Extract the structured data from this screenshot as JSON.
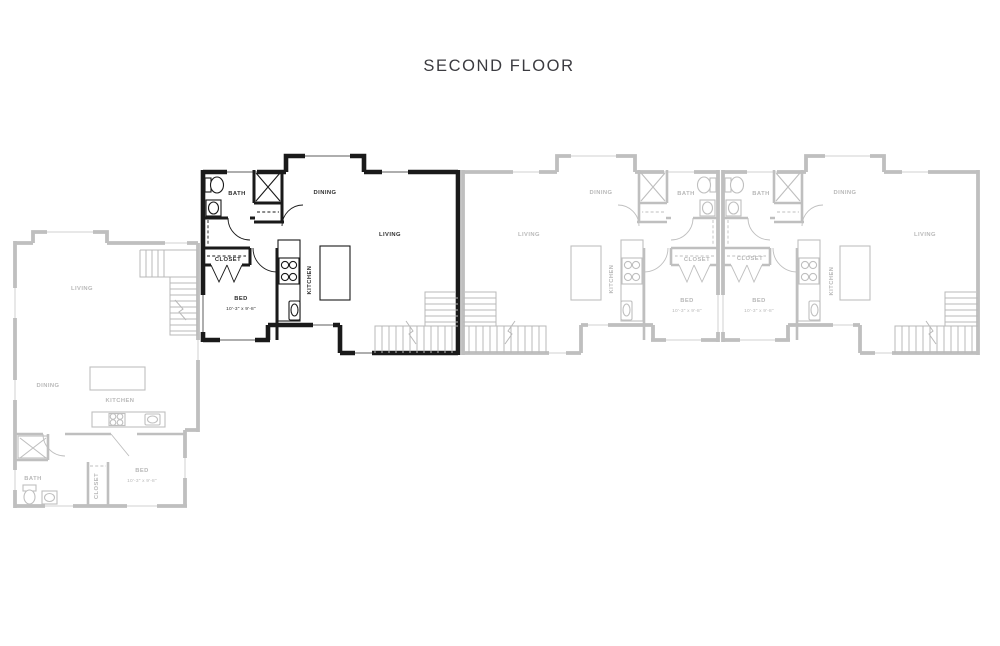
{
  "title": "SECOND FLOOR",
  "colors": {
    "background": "#ffffff",
    "highlight": "#1a1a1a",
    "faded": "#bfbfbf",
    "stairs": "#b8b8b8",
    "title_text": "#3b3b40",
    "label_text_highlight": "#2e2e2e",
    "label_text_faded": "#b8b8b8"
  },
  "units": [
    {
      "id": "unit-1",
      "state": "faded",
      "labels": {
        "living": "LIVING",
        "dining": "DINING",
        "kitchen": "KITCHEN",
        "bath": "BATH",
        "closet": "CLOSET",
        "bed": "BED",
        "bed_dimensions": "10'-3\" x 9'-8\""
      }
    },
    {
      "id": "unit-2",
      "state": "highlighted",
      "labels": {
        "living": "LIVING",
        "dining": "DINING",
        "kitchen": "KITCHEN",
        "bath": "BATH",
        "closet": "CLOSET",
        "bed": "BED",
        "bed_dimensions": "10'-3\" x 9'-8\""
      }
    },
    {
      "id": "unit-3",
      "state": "faded",
      "labels": {
        "living": "LIVING",
        "dining": "DINING",
        "kitchen": "KITCHEN",
        "bath": "BATH",
        "closet": "CLOSET",
        "bed": "BED",
        "bed_dimensions": "10'-3\" x 9'-8\""
      }
    },
    {
      "id": "unit-4",
      "state": "faded",
      "labels": {
        "living": "LIVING",
        "dining": "DINING",
        "kitchen": "KITCHEN",
        "bath": "BATH",
        "closet": "CLOSET",
        "bed": "BED",
        "bed_dimensions": "10'-3\" x 9'-8\""
      }
    }
  ]
}
